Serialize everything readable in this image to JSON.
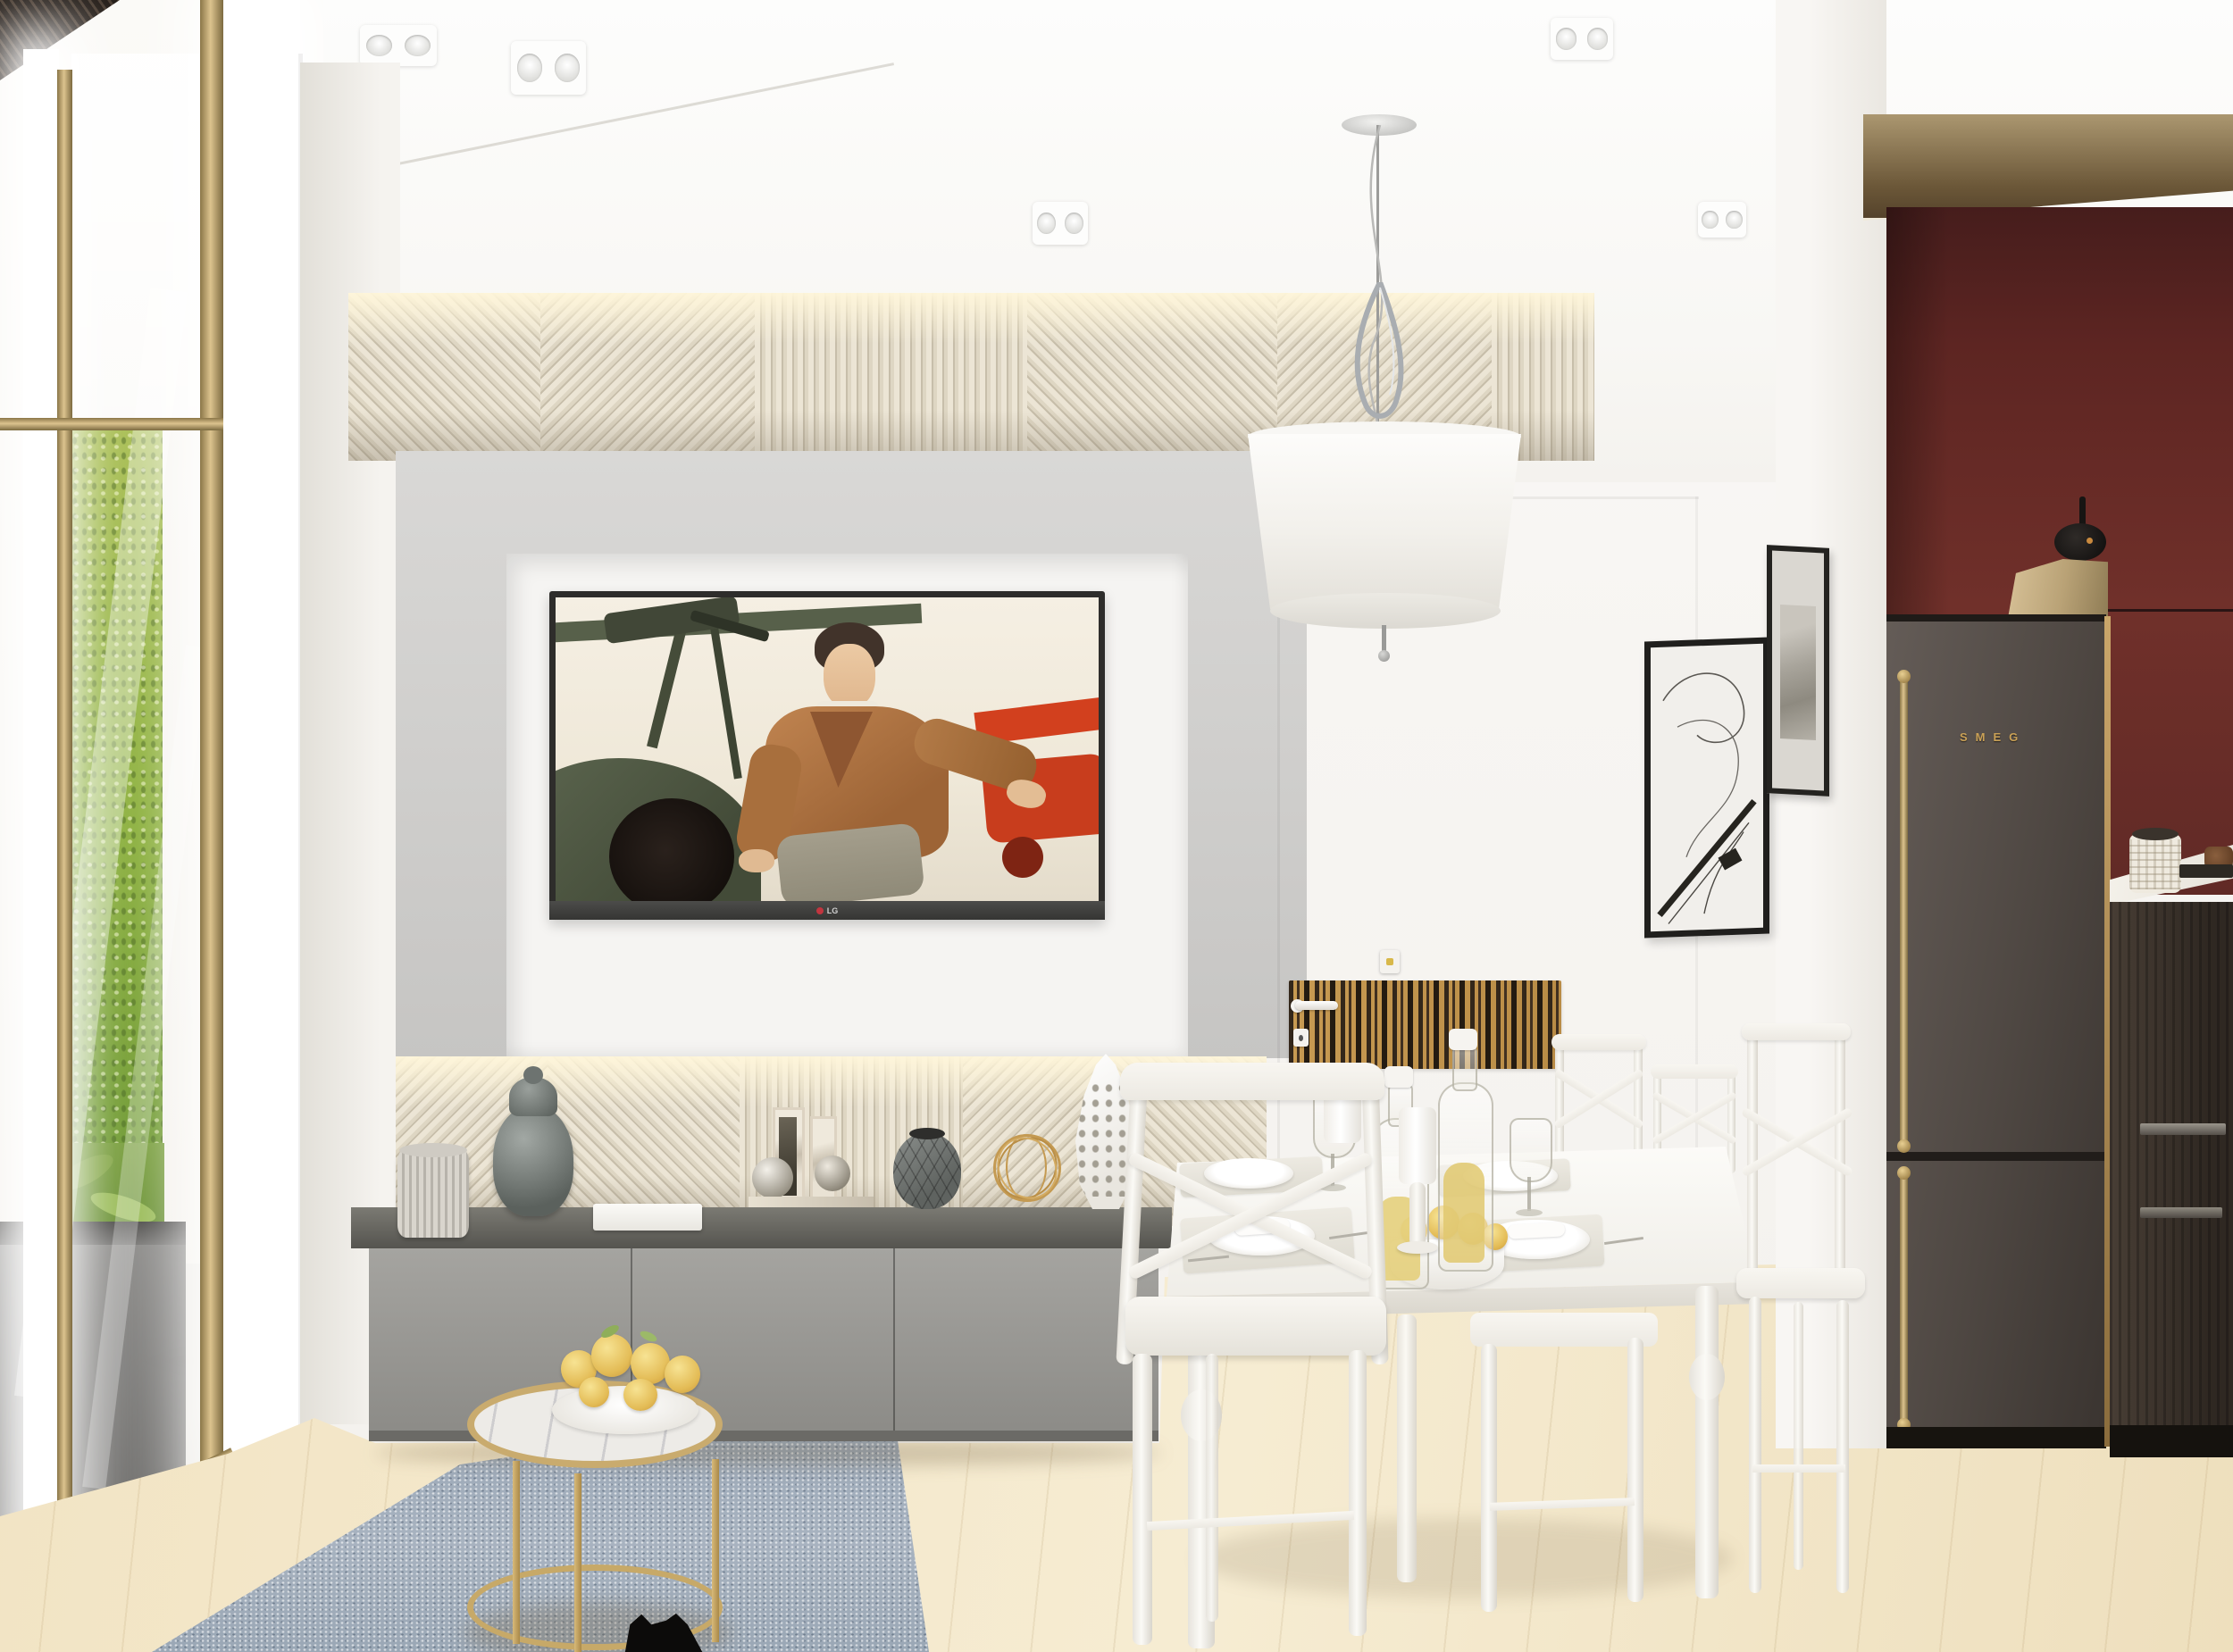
{
  "meta": {
    "domain": "Natural-Image",
    "description": "Photorealistic 3D interior render of a modern apartment: living area with wall TV and sideboard, white dining nook, and burgundy kitchen corner with charcoal fridge."
  },
  "tv": {
    "brand": "LG",
    "screen_subject": "Film still of a young man in a brown leather aviator jacket seated on a vintage green biplane, red biplane behind him"
  },
  "fridge": {
    "brand": "SMEG"
  },
  "palette": {
    "wall_white": "#f5f3f0",
    "panel_gray": "#cfcecb",
    "slat_cream": "#e3dbc9",
    "burgundy_wall": "#5e2824",
    "brass": "#c9ab6e",
    "wood_floor": "#f0e2c0",
    "rug_blue_gray": "#9fadbb",
    "moss_green": "#85a744",
    "sideboard_gray": "#97968f",
    "fridge_charcoal": "#4e4742"
  },
  "objects": [
    {
      "label": "glass partition with brass frame and moss wall behind"
    },
    {
      "label": "decorative diagonal slat wall band, LED backlit"
    },
    {
      "label": "wall-mounted LG TV in white niche on gray panel"
    },
    {
      "label": "gray floating sideboard with vases, book, bookends, wire sphere"
    },
    {
      "label": "white dining table set for four with oil bottles, candles and pears"
    },
    {
      "label": "white cross-back dining chairs"
    },
    {
      "label": "pendant lamp with chrome twist ornament and white drum shade"
    },
    {
      "label": "two black framed artworks on white column"
    },
    {
      "label": "concealed door with zebrano wood band, handle and switch"
    },
    {
      "label": "burgundy kitchen wall with black disc sconce"
    },
    {
      "label": "charcoal SMEG fridge with brass handles"
    },
    {
      "label": "marble counter with ceramic canister and wooden bowl"
    },
    {
      "label": "gold round coffee table with marble top and plate of pears"
    },
    {
      "label": "blue-gray rug on light wood floor"
    },
    {
      "label": "black cat silhouette at bottom edge"
    }
  ]
}
